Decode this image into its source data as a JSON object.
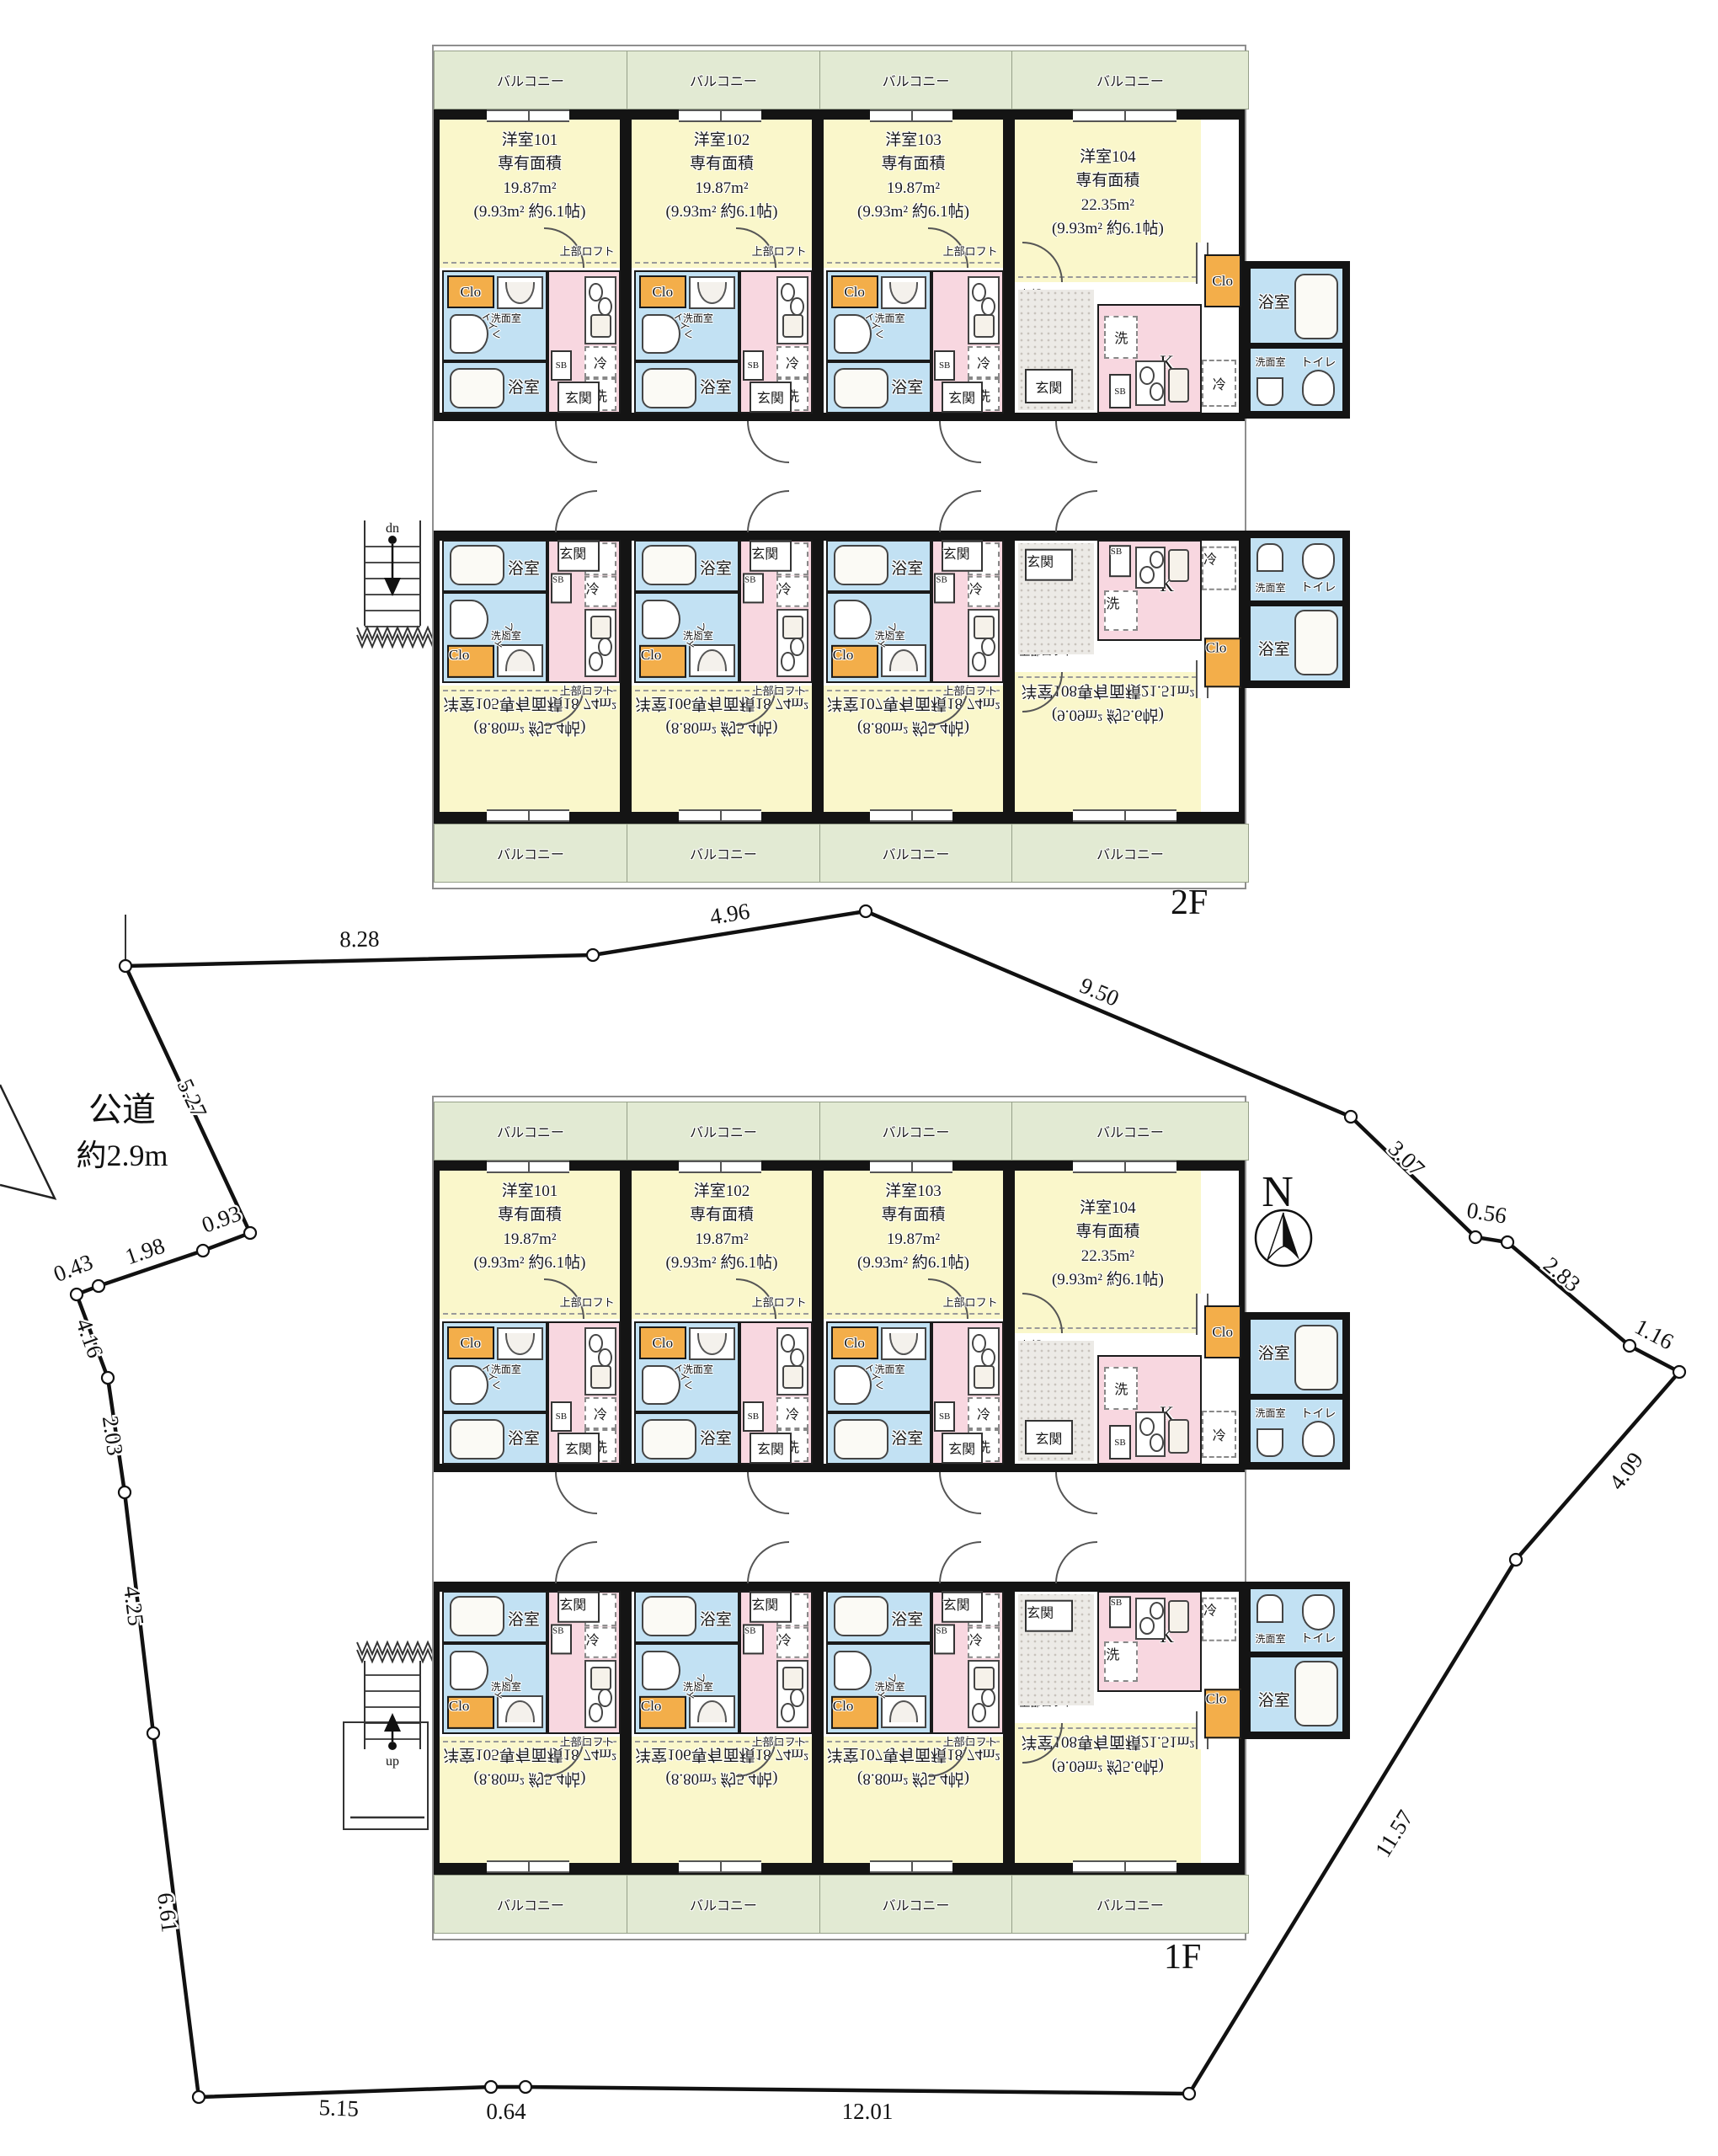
{
  "site": {
    "road_label_1": "公道",
    "road_label_2": "約2.9m",
    "north_label": "N",
    "dims": [
      "8.28",
      "4.96",
      "9.50",
      "3.07",
      "0.56",
      "2.83",
      "1.16",
      "4.09",
      "11.57",
      "12.01",
      "0.64",
      "5.15",
      "6.61",
      "4.25",
      "2.03",
      "4.16",
      "0.43",
      "1.98",
      "0.93",
      "5.27"
    ]
  },
  "labels": {
    "balcony": "バルコニー",
    "closet": "Clo",
    "washroom": "洗面室",
    "toilet": "トイレ",
    "bath": "浴室",
    "entrance": "玄関",
    "shoe_box": "SB",
    "fridge": "冷",
    "washer": "洗",
    "kitchen": "K",
    "loft": "上部ロフト"
  },
  "floors": [
    {
      "label": "2F",
      "stair_label": "dn",
      "units": [
        {
          "name": "洋室101",
          "area_caption": "専有面積",
          "area": "19.87m²",
          "loft_area": "(9.93m² 約6.1帖)"
        },
        {
          "name": "洋室102",
          "area_caption": "専有面積",
          "area": "19.87m²",
          "loft_area": "(9.93m² 約6.1帖)"
        },
        {
          "name": "洋室103",
          "area_caption": "専有面積",
          "area": "19.87m²",
          "loft_area": "(9.93m² 約6.1帖)"
        },
        {
          "name": "洋室104",
          "area_caption": "専有面積",
          "area": "22.35m²",
          "loft_area": "(9.93m² 約6.1帖)"
        },
        {
          "name": "洋室105",
          "area_caption": "専有面積",
          "area": "18.74m²",
          "loft_area": "(8.80m² 約5.4帖)"
        },
        {
          "name": "洋室106",
          "area_caption": "専有面積",
          "area": "18.74m²",
          "loft_area": "(8.80m² 約5.4帖)"
        },
        {
          "name": "洋室107",
          "area_caption": "専有面積",
          "area": "18.74m²",
          "loft_area": "(8.80m² 約5.4帖)"
        },
        {
          "name": "洋室108",
          "area_caption": "専有面積",
          "area": "21.51m²",
          "loft_area": "(9.09m² 約5.6帖)"
        }
      ]
    },
    {
      "label": "1F",
      "stair_label": "up",
      "units": [
        {
          "name": "洋室101",
          "area_caption": "専有面積",
          "area": "19.87m²",
          "loft_area": "(9.93m² 約6.1帖)"
        },
        {
          "name": "洋室102",
          "area_caption": "専有面積",
          "area": "19.87m²",
          "loft_area": "(9.93m² 約6.1帖)"
        },
        {
          "name": "洋室103",
          "area_caption": "専有面積",
          "area": "19.87m²",
          "loft_area": "(9.93m² 約6.1帖)"
        },
        {
          "name": "洋室104",
          "area_caption": "専有面積",
          "area": "22.35m²",
          "loft_area": "(9.93m² 約6.1帖)"
        },
        {
          "name": "洋室105",
          "area_caption": "専有面積",
          "area": "18.74m²",
          "loft_area": "(8.80m² 約5.4帖)"
        },
        {
          "name": "洋室106",
          "area_caption": "専有面積",
          "area": "18.74m²",
          "loft_area": "(8.80m² 約5.4帖)"
        },
        {
          "name": "洋室107",
          "area_caption": "専有面積",
          "area": "18.74m²",
          "loft_area": "(8.80m² 約5.4帖)"
        },
        {
          "name": "洋室108",
          "area_caption": "専有面積",
          "area": "21.51m²",
          "loft_area": "(9.09m² 約5.6帖)"
        }
      ]
    }
  ],
  "colors": {
    "room_yellow": "#FAF7CB",
    "balcony_green": "#E2EAD3",
    "water_blue": "#C2E1F3",
    "kitchen_pink": "#F8D7E0",
    "closet_orange": "#F3AE4A",
    "wall_black": "#141414",
    "boundary_black": "#111111"
  }
}
